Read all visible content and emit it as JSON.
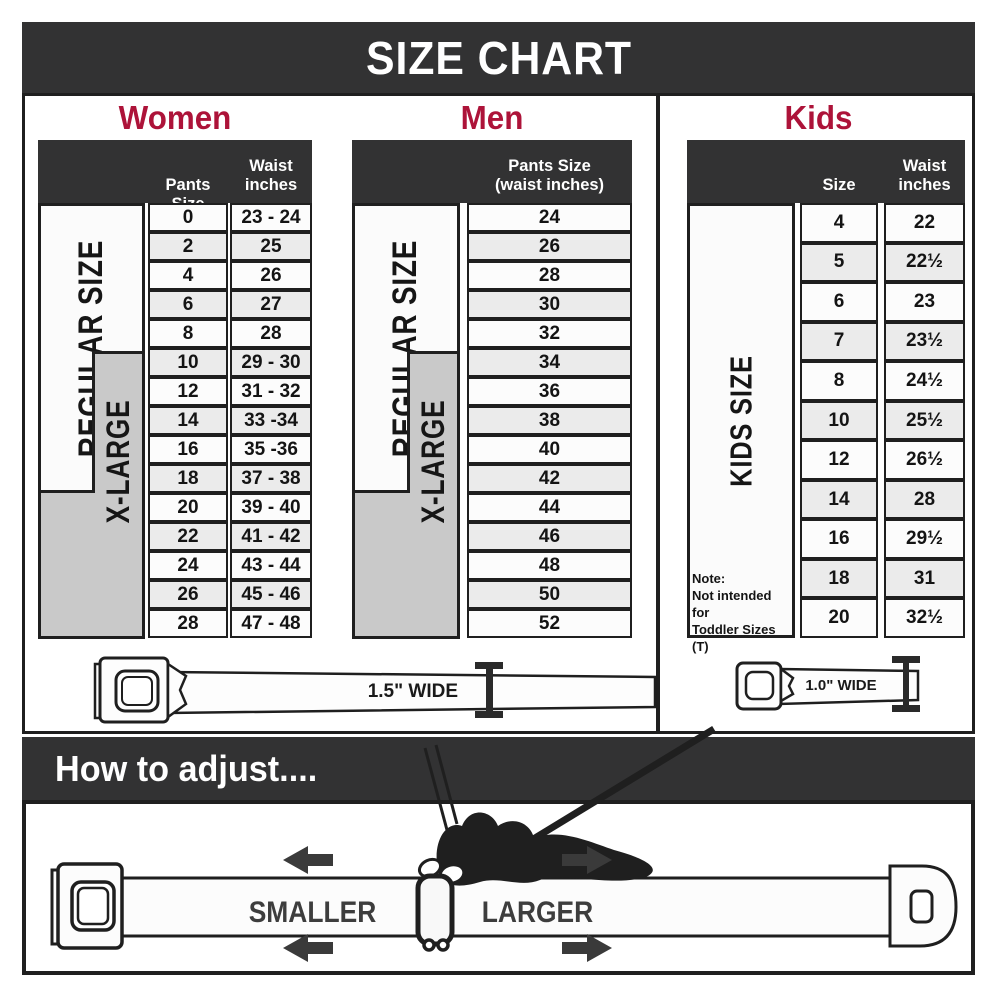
{
  "title": "SIZE CHART",
  "colors": {
    "band_dark": "#323233",
    "accent_red": "#ad1339",
    "row_alt_gray": "#ebebeb",
    "xlarge_gray": "#c9c9c9",
    "line_black": "#1f1f1f"
  },
  "women": {
    "heading": "Women",
    "col_pants": "Pants Size",
    "col_waist_line1": "Waist",
    "col_waist_line2": "inches",
    "regular_label": "REGULAR SIZE",
    "xlarge_label": "X-LARGE",
    "rows": [
      {
        "size": "0",
        "waist": "23 - 24"
      },
      {
        "size": "2",
        "waist": "25"
      },
      {
        "size": "4",
        "waist": "26"
      },
      {
        "size": "6",
        "waist": "27"
      },
      {
        "size": "8",
        "waist": "28"
      },
      {
        "size": "10",
        "waist": "29 - 30"
      },
      {
        "size": "12",
        "waist": "31 - 32"
      },
      {
        "size": "14",
        "waist": "33 -34"
      },
      {
        "size": "16",
        "waist": "35 -36"
      },
      {
        "size": "18",
        "waist": "37 - 38"
      },
      {
        "size": "20",
        "waist": "39 - 40"
      },
      {
        "size": "22",
        "waist": "41 - 42"
      },
      {
        "size": "24",
        "waist": "43 - 44"
      },
      {
        "size": "26",
        "waist": "45 - 46"
      },
      {
        "size": "28",
        "waist": "47 - 48"
      }
    ]
  },
  "men": {
    "heading": "Men",
    "col_line1": "Pants Size",
    "col_line2": "(waist inches)",
    "regular_label": "REGULAR SIZE",
    "xlarge_label": "X-LARGE",
    "rows": [
      "24",
      "26",
      "28",
      "30",
      "32",
      "34",
      "36",
      "38",
      "40",
      "42",
      "44",
      "46",
      "48",
      "50",
      "52"
    ]
  },
  "kids": {
    "heading": "Kids",
    "col_size": "Size",
    "col_waist_line1": "Waist",
    "col_waist_line2": "inches",
    "side_label": "KIDS SIZE",
    "note_line1": "Note:",
    "note_line2": "Not intended for",
    "note_line3": "Toddler Sizes (T)",
    "rows": [
      {
        "size": "4",
        "waist": "22"
      },
      {
        "size": "5",
        "waist": "22½"
      },
      {
        "size": "6",
        "waist": "23"
      },
      {
        "size": "7",
        "waist": "23½"
      },
      {
        "size": "8",
        "waist": "24½"
      },
      {
        "size": "10",
        "waist": "25½"
      },
      {
        "size": "12",
        "waist": "26½"
      },
      {
        "size": "14",
        "waist": "28"
      },
      {
        "size": "16",
        "waist": "29½"
      },
      {
        "size": "18",
        "waist": "31"
      },
      {
        "size": "20",
        "waist": "32½"
      }
    ]
  },
  "belts": {
    "adult_width_label": "1.5\" WIDE",
    "kids_width_label": "1.0\" WIDE"
  },
  "adjust": {
    "heading": "How to adjust....",
    "smaller_label": "SMALLER",
    "larger_label": "LARGER"
  },
  "chart_data": [
    {
      "type": "table",
      "title": "Women",
      "columns": [
        "Pants Size",
        "Waist inches"
      ],
      "rows": [
        [
          "0",
          "23 - 24"
        ],
        [
          "2",
          "25"
        ],
        [
          "4",
          "26"
        ],
        [
          "6",
          "27"
        ],
        [
          "8",
          "28"
        ],
        [
          "10",
          "29 - 30"
        ],
        [
          "12",
          "31 - 32"
        ],
        [
          "14",
          "33 -34"
        ],
        [
          "16",
          "35 -36"
        ],
        [
          "18",
          "37 - 38"
        ],
        [
          "20",
          "39 - 40"
        ],
        [
          "22",
          "41 - 42"
        ],
        [
          "24",
          "43 - 44"
        ],
        [
          "26",
          "45 - 46"
        ],
        [
          "28",
          "47 - 48"
        ]
      ]
    },
    {
      "type": "table",
      "title": "Men",
      "columns": [
        "Pants Size (waist inches)"
      ],
      "rows": [
        [
          "24"
        ],
        [
          "26"
        ],
        [
          "28"
        ],
        [
          "30"
        ],
        [
          "32"
        ],
        [
          "34"
        ],
        [
          "36"
        ],
        [
          "38"
        ],
        [
          "40"
        ],
        [
          "42"
        ],
        [
          "44"
        ],
        [
          "46"
        ],
        [
          "48"
        ],
        [
          "50"
        ],
        [
          "52"
        ]
      ]
    },
    {
      "type": "table",
      "title": "Kids",
      "columns": [
        "Size",
        "Waist inches"
      ],
      "rows": [
        [
          "4",
          "22"
        ],
        [
          "5",
          "22½"
        ],
        [
          "6",
          "23"
        ],
        [
          "7",
          "23½"
        ],
        [
          "8",
          "24½"
        ],
        [
          "10",
          "25½"
        ],
        [
          "12",
          "26½"
        ],
        [
          "14",
          "28"
        ],
        [
          "16",
          "29½"
        ],
        [
          "18",
          "31"
        ],
        [
          "20",
          "32½"
        ]
      ]
    }
  ]
}
